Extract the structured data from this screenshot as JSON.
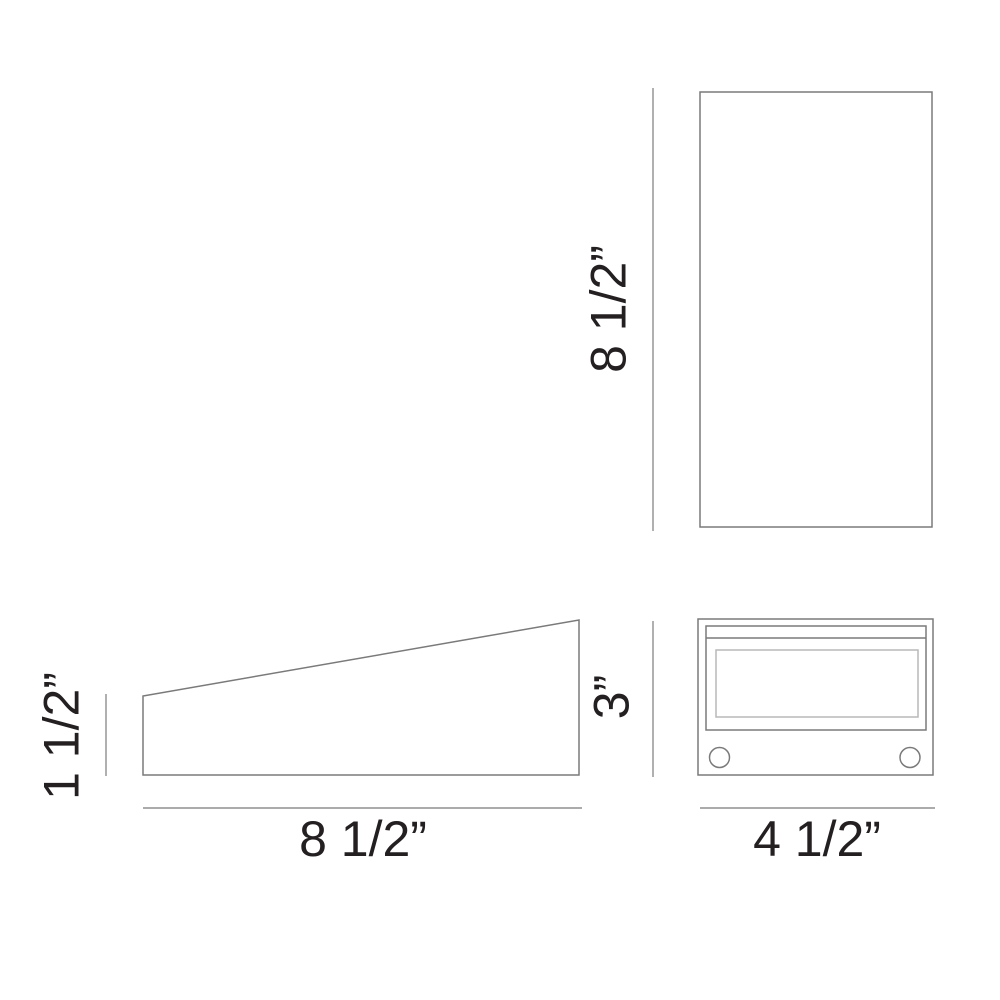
{
  "drawing": {
    "views": {
      "top": {
        "height_label": "8 1/2”"
      },
      "side": {
        "back_height_label": "1 1/2”",
        "length_label": "8 1/2”"
      },
      "front": {
        "height_label": "3”",
        "width_label": "4 1/2”"
      }
    },
    "colors": {
      "line": "#7a7a7a",
      "dim_line": "#8f8f8f",
      "lens_line": "#b8b8b8",
      "text": "#242021",
      "background": "#ffffff"
    }
  }
}
